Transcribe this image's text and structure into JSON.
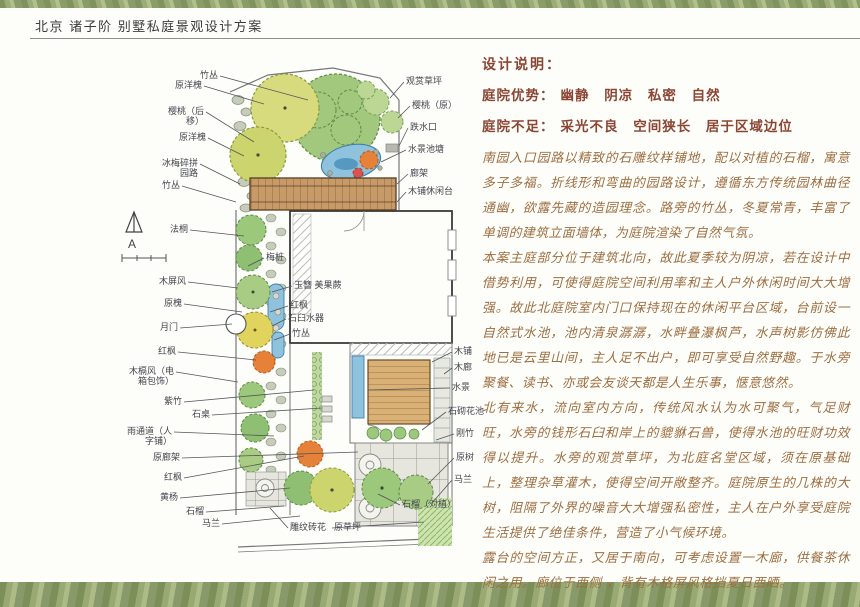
{
  "page": {
    "title": "北京 诸子阶 别墅私庭景观设计方案"
  },
  "design_notes": {
    "heading": "设计说明：",
    "advantages_label": "庭院优势：",
    "advantages": "幽静 阴凉 私密 自然",
    "disadvantages_label": "庭院不足：",
    "disadvantages": "采光不良 空间狭长 居于区域边位",
    "paragraphs": [
      "南园入口园路以精致的石雕纹样铺地，配以对植的石榴，寓意多子多福。折线形和弯曲的园路设计，遵循东方传统园林曲径通幽，欲露先藏的造园理念。路旁的竹丛，冬夏常青，丰富了单调的建筑立面墙体，为庭院渲染了自然气氛。",
      "本案主庭部分位于建筑北向，故此夏季较为阴凉，若在设计中借势利用，可使得庭院空间利用率和主人户外休闲时间大大增强。故此北庭院室内门口保持现在的休闲平台区域，台前设一自然式水池，池内清泉潺潺，水畔叠瀑枫芦，水声树影仿佛此地已是云里山间，主人足不出户，即可享受自然野趣。于水旁聚餐、读书、亦或会友谈天都是人生乐事，惬意悠然。",
      "北有来水，流向室内方向，传统风水认为水可聚气，气足财旺，水旁的钱形石臼和岸上的貔貅石兽，使得水池的旺财功效得以提升。水旁的观赏草坪，为北庭名堂区域，须在原基础上，整理杂草灌木，使得空间开敞整齐。庭院原生的几株的大树，阻隔了外界的噪音大大增强私密性，主人在户外享受庭院生活提供了绝佳条件，营造了小气候环境。",
      "露台的空间方正，又居于南向，可考虑设置一木廊，供餐茶休闲之用。廊位于西侧 ，背有木格屏风格挡夏日西晒。"
    ]
  },
  "plan": {
    "north_label": "A",
    "labels": [
      {
        "t": "竹丛",
        "a": "l",
        "x": 100,
        "y": 16,
        "tx": 190,
        "ty": 40
      },
      {
        "t": "原洋槐",
        "a": "l",
        "x": 84,
        "y": 26,
        "tx": 146,
        "ty": 44
      },
      {
        "t": "樱桃（后移）",
        "a": "l",
        "x": 86,
        "y": 52,
        "w": 36,
        "tx": 136,
        "ty": 82
      },
      {
        "t": "原洋槐",
        "a": "l",
        "x": 88,
        "y": 78,
        "tx": 126,
        "ty": 96
      },
      {
        "t": "冰梅碎拼园路",
        "a": "l",
        "x": 80,
        "y": 104,
        "w": 44,
        "tx": 122,
        "ty": 124
      },
      {
        "t": "竹丛",
        "a": "l",
        "x": 62,
        "y": 126,
        "tx": 118,
        "ty": 142
      },
      {
        "t": "法桐",
        "a": "l",
        "x": 70,
        "y": 170,
        "tx": 126,
        "ty": 176
      },
      {
        "t": "木屏风",
        "a": "l",
        "x": 68,
        "y": 222,
        "tx": 120,
        "ty": 228
      },
      {
        "t": "原槐",
        "a": "l",
        "x": 64,
        "y": 244,
        "tx": 124,
        "ty": 252
      },
      {
        "t": "月门",
        "a": "l",
        "x": 60,
        "y": 268,
        "tx": 114,
        "ty": 264
      },
      {
        "t": "红枫",
        "a": "l",
        "x": 58,
        "y": 292,
        "tx": 138,
        "ty": 300
      },
      {
        "t": "木槅风（电箱包饰）",
        "a": "l",
        "x": 56,
        "y": 312,
        "w": 52,
        "tx": 120,
        "ty": 322
      },
      {
        "t": "紫竹",
        "a": "l",
        "x": 64,
        "y": 342,
        "tx": 196,
        "ty": 330
      },
      {
        "t": "石桌",
        "a": "l",
        "x": 92,
        "y": 355,
        "tx": 204,
        "ty": 348
      },
      {
        "t": "雨通道（人字铺）",
        "a": "l",
        "x": 54,
        "y": 372,
        "w": 46,
        "tx": 156,
        "ty": 376
      },
      {
        "t": "原廊架",
        "a": "l",
        "x": 62,
        "y": 398,
        "tx": 240,
        "ty": 392
      },
      {
        "t": "红枫",
        "a": "l",
        "x": 64,
        "y": 418,
        "tx": 186,
        "ty": 396
      },
      {
        "t": "黄杨",
        "a": "l",
        "x": 60,
        "y": 438,
        "tx": 172,
        "ty": 428
      },
      {
        "t": "石榴",
        "a": "l",
        "x": 86,
        "y": 452,
        "tx": 166,
        "ty": 446
      },
      {
        "t": "马兰",
        "a": "l",
        "x": 102,
        "y": 464,
        "tx": 182,
        "ty": 456
      },
      {
        "t": "观赏草坪",
        "a": "r",
        "x": 288,
        "y": 22,
        "tx": 272,
        "ty": 38
      },
      {
        "t": "樱桃（原）",
        "a": "r",
        "x": 294,
        "y": 46,
        "tx": 280,
        "ty": 58
      },
      {
        "t": "跌水口",
        "a": "r",
        "x": 292,
        "y": 68,
        "tx": 281,
        "ty": 86
      },
      {
        "t": "水景池塘",
        "a": "r",
        "x": 290,
        "y": 90,
        "tx": 263,
        "ty": 102
      },
      {
        "t": "廊架",
        "a": "r",
        "x": 292,
        "y": 114,
        "tx": 279,
        "ty": 124
      },
      {
        "t": "木铺休闲台",
        "a": "r",
        "x": 290,
        "y": 132,
        "tx": 279,
        "ty": 142
      },
      {
        "t": "梅桩",
        "a": "r",
        "x": 148,
        "y": 198,
        "tx": 130,
        "ty": 206
      },
      {
        "t": "玉簪 美果蕨",
        "a": "r",
        "x": 176,
        "y": 226,
        "tx": 154,
        "ty": 232
      },
      {
        "t": "红枫",
        "a": "r",
        "x": 172,
        "y": 246,
        "tx": 152,
        "ty": 252
      },
      {
        "t": "石臼水器",
        "a": "r",
        "x": 170,
        "y": 259,
        "tx": 154,
        "ty": 266
      },
      {
        "t": "竹丛",
        "a": "r",
        "x": 174,
        "y": 274,
        "tx": 156,
        "ty": 280
      },
      {
        "t": "木铺",
        "a": "r",
        "x": 336,
        "y": 292,
        "tx": 314,
        "ty": 302
      },
      {
        "t": "木廊",
        "a": "r",
        "x": 336,
        "y": 308,
        "tx": 326,
        "ty": 314
      },
      {
        "t": "水景",
        "a": "r",
        "x": 334,
        "y": 328,
        "tx": 250,
        "ty": 330
      },
      {
        "t": "石砌花池",
        "a": "r",
        "x": 330,
        "y": 352,
        "tx": 304,
        "ty": 370
      },
      {
        "t": "刚竹",
        "a": "r",
        "x": 338,
        "y": 374,
        "tx": 318,
        "ty": 380
      },
      {
        "t": "原树",
        "a": "r",
        "x": 338,
        "y": 398,
        "tx": 310,
        "ty": 424
      },
      {
        "t": "马兰",
        "a": "r",
        "x": 336,
        "y": 420,
        "tx": 314,
        "ty": 443
      },
      {
        "t": "石榴（对植）",
        "a": "r",
        "x": 284,
        "y": 445,
        "tx": 260,
        "ty": 434
      },
      {
        "t": "雕纹砖花",
        "a": "r",
        "x": 172,
        "y": 468,
        "tx": 152,
        "ty": 448
      },
      {
        "t": "原草坪",
        "a": "r",
        "x": 216,
        "y": 468,
        "tx": 306,
        "ty": 462
      }
    ]
  },
  "colors": {
    "accent_heading": "#8a4633",
    "body_text": "#9c6f42",
    "title_text": "#3c3c3c",
    "label_ink": "#44464e",
    "band_green": "#8e9e6e",
    "pond_blue": "#8fc3dd",
    "deck_brown": "#c89a68"
  }
}
